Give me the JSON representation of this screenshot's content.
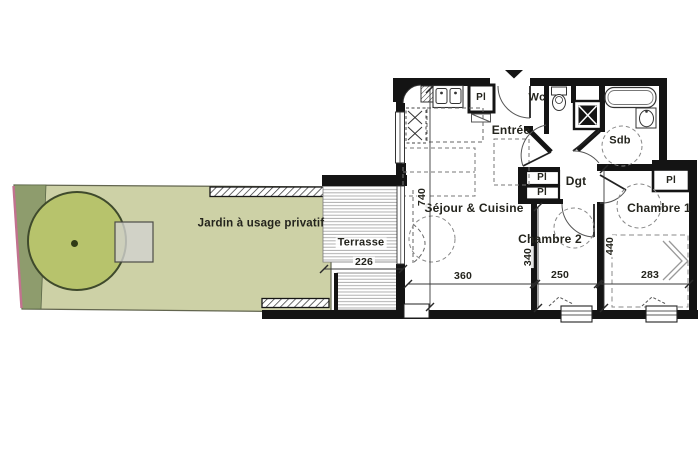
{
  "plan": {
    "garden": {
      "label": "Jardin à usage privatif"
    },
    "terrace": {
      "label": "Terrasse"
    },
    "rooms": {
      "living": {
        "label": "Séjour & Cuisine"
      },
      "entry": {
        "label": "Entrée"
      },
      "wc": {
        "label": "Wc"
      },
      "bathroom": {
        "label": "Sdb"
      },
      "hall": {
        "label": "Dgt"
      },
      "bedroom2": {
        "label": "Chambre 2"
      },
      "bedroom1": {
        "label": "Chambre 1"
      }
    },
    "closet_label": "Pl",
    "dimensions_cm": {
      "living_depth": "740",
      "terrace_width": "226",
      "living_width": "360",
      "bedroom2_depth": "340",
      "bedroom2_width": "250",
      "bedroom1_depth": "440",
      "bedroom1_width": "283"
    },
    "colors": {
      "garden_fill": "#cdd1a6",
      "garden_edge_strip": "#8e9c6d",
      "tree_fill": "#b7c36c",
      "paving_fill": "#d2d2d0",
      "boundary_accent": "#c2728f",
      "wall": "#141414"
    }
  }
}
